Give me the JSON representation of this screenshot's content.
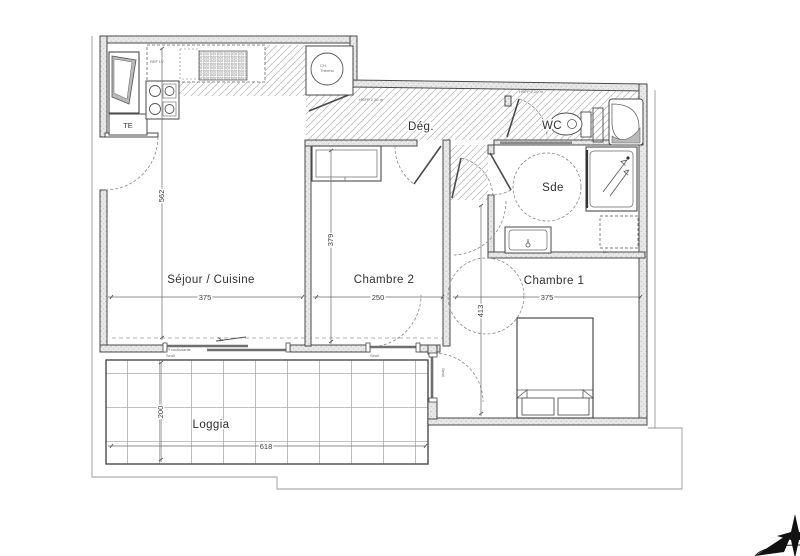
{
  "rooms": {
    "sejour": {
      "label": "Séjour / Cuisine",
      "width": "375",
      "height": "562"
    },
    "chambre2": {
      "label": "Chambre 2",
      "width": "250",
      "height": "379"
    },
    "chambre1": {
      "label": "Chambre 1",
      "width": "375",
      "height": "413"
    },
    "sde": {
      "label": "Sde"
    },
    "wc": {
      "label": "WC"
    },
    "deg": {
      "label": "Dég."
    },
    "loggia": {
      "label": "Loggia",
      "width": "618",
      "height": "200"
    }
  },
  "fixtures": {
    "electrical_panel": "TE",
    "water_heater_line1": "CH",
    "water_heater_line2": "Thermo",
    "fridge_note": "REF LV",
    "washer_note": "LL"
  },
  "notes": {
    "ceiling_deg": "HSFP 2,20 m",
    "ceiling_wc": "HSFP 2,20 m",
    "sill_sejour": "Seuil",
    "sill_chambre2": "Seuil",
    "sill_chambre1": "Seuil",
    "bay_note": "Pf coulissante"
  },
  "colors": {
    "line": "#4a4a4a",
    "wall_fill": "#e6e6e6",
    "hatch": "#bcbcbc",
    "text": "#2f2f2f"
  }
}
